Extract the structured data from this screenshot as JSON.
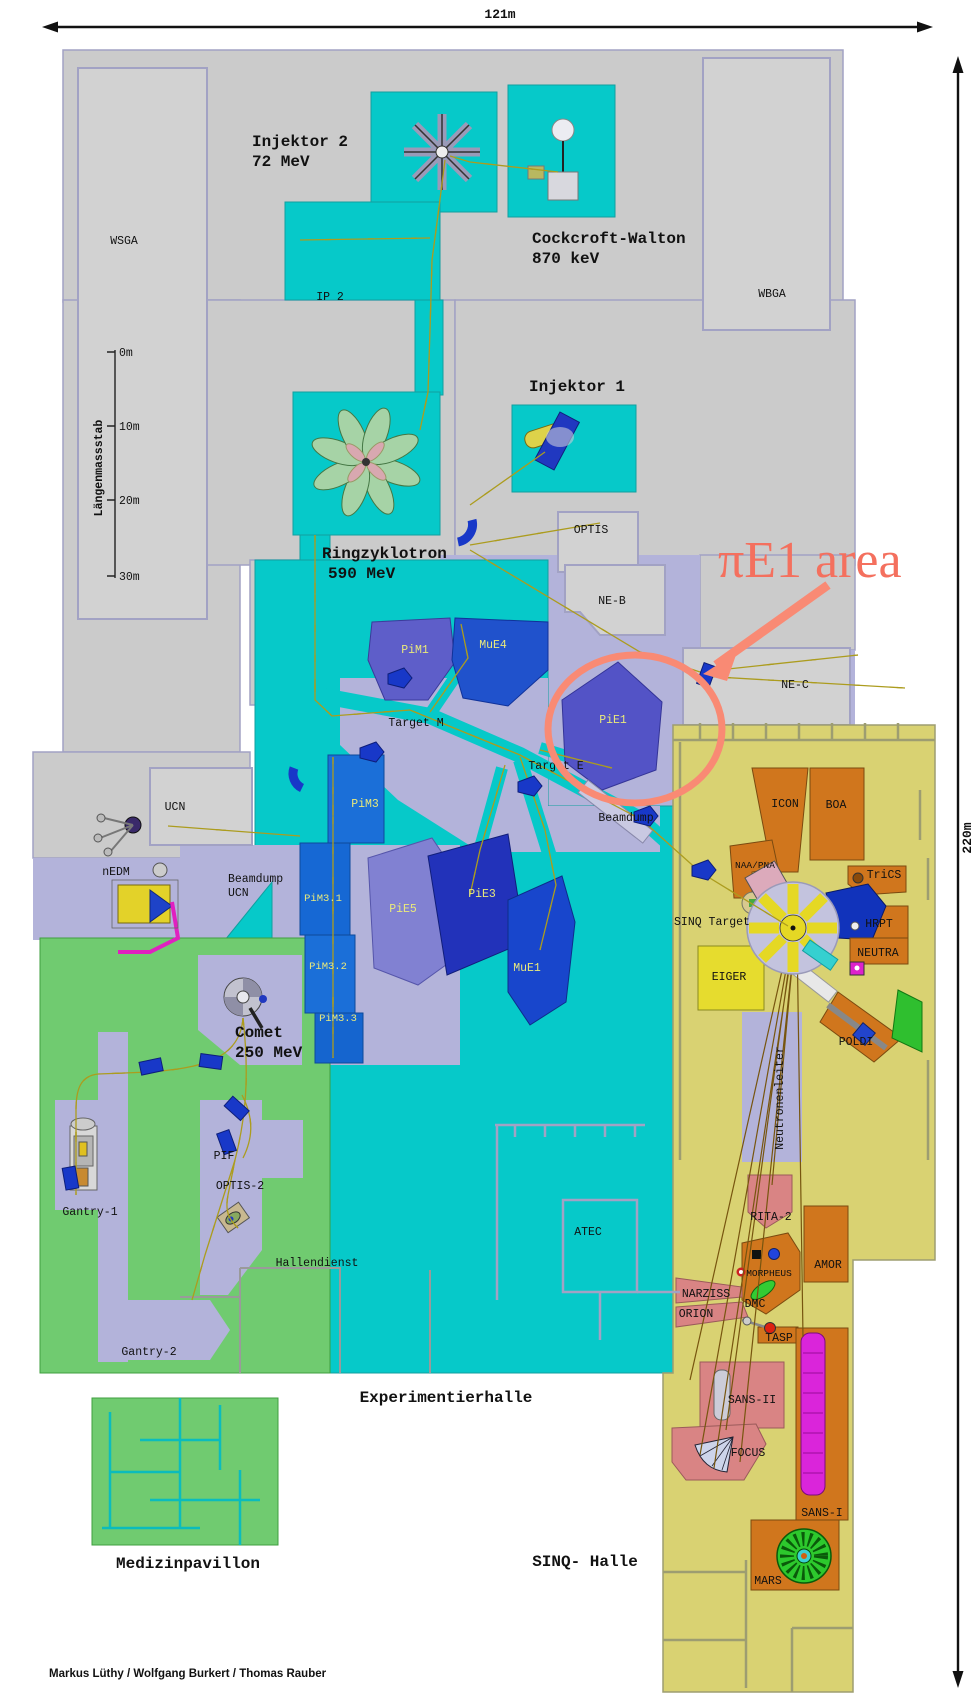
{
  "dimension": {
    "width": "121m",
    "height": "220m"
  },
  "scale_bar": {
    "title": "Längenmassstab",
    "ticks": [
      "0m",
      "10m",
      "20m",
      "30m"
    ]
  },
  "machines": {
    "injektor2": {
      "name": "Injektor 2",
      "energy": "72 MeV"
    },
    "cockcroft_walton": {
      "name": "Cockcroft-Walton",
      "energy": "870 keV"
    },
    "injektor1": {
      "name": "Injektor 1"
    },
    "ringzyklotron": {
      "name": "Ringzyklotron",
      "energy": "590 MeV"
    },
    "comet": {
      "name": "Comet",
      "energy": "250 MeV"
    }
  },
  "halls": {
    "experimentierhalle": "Experimentierhalle",
    "sinq_halle": "SINQ- Halle",
    "medizinpavillon": "Medizinpavillon"
  },
  "rooms": {
    "wsga": "WSGA",
    "wbga": "WBGA",
    "ip2": "IP 2",
    "optis": "OPTIS",
    "ne_b": "NE-B",
    "ne_c": "NE-C",
    "ucn": "UCN",
    "nedm": "nEDM",
    "beamdump_ucn_line1": "Beamdump",
    "beamdump_ucn_line2": "UCN",
    "beamdump": "Beamdump",
    "target_m": "Target M",
    "target_e": "Target E",
    "hallendienst": "Hallendienst",
    "atec": "ATEC",
    "gantry1": "Gantry-1",
    "gantry2": "Gantry-2",
    "pif": "PIF",
    "optis2": "OPTIS-2"
  },
  "beam_areas": {
    "pim1": "PiM1",
    "mue4": "MuE4",
    "pie1": "PiE1",
    "pim3": "PiM3",
    "pim3_1": "PiM3.1",
    "pim3_2": "PiM3.2",
    "pim3_3": "PiM3.3",
    "pie5": "PiE5",
    "pie3": "PiE3",
    "mue1": "MuE1"
  },
  "sinq": {
    "sinq_target": "SINQ Target",
    "neutronenleiter": "Neutronenleiter",
    "icon": "ICON",
    "boa": "BOA",
    "naa_pna": "NAA/PNA",
    "trics": "TriCS",
    "hrpt": "HRPT",
    "neutra": "NEUTRA",
    "eiger": "EIGER",
    "poldi": "POLDI",
    "rita2": "RITA-2",
    "amor": "AMOR",
    "morpheus": "MORPHEUS",
    "narziss": "NARZISS",
    "orion": "ORION",
    "dmc": "DMC",
    "tasp": "TASP",
    "sans2": "SANS-II",
    "focus": "FOCUS",
    "sans1": "SANS-I",
    "mars": "MARS"
  },
  "annotation": {
    "label": "πE1 area",
    "color": "#f4705e"
  },
  "credits": "Markus Lüthy / Wolfgang Burkert / Thomas Rauber",
  "palette": {
    "building_gray": "#cbcbcb",
    "wall_lavender": "#a2a2c4",
    "hall_cyan": "#06c9c9",
    "zone_lavender": "#b3b3da",
    "medical_green": "#70cb70",
    "sinq_yellow": "#d9d272",
    "instrument_orange": "#d0761d",
    "instrument_salmon": "#d98484",
    "magnet_red": "#d62b15",
    "magnet_blue": "#1838c8",
    "annotation_salmon": "#f4705e"
  }
}
